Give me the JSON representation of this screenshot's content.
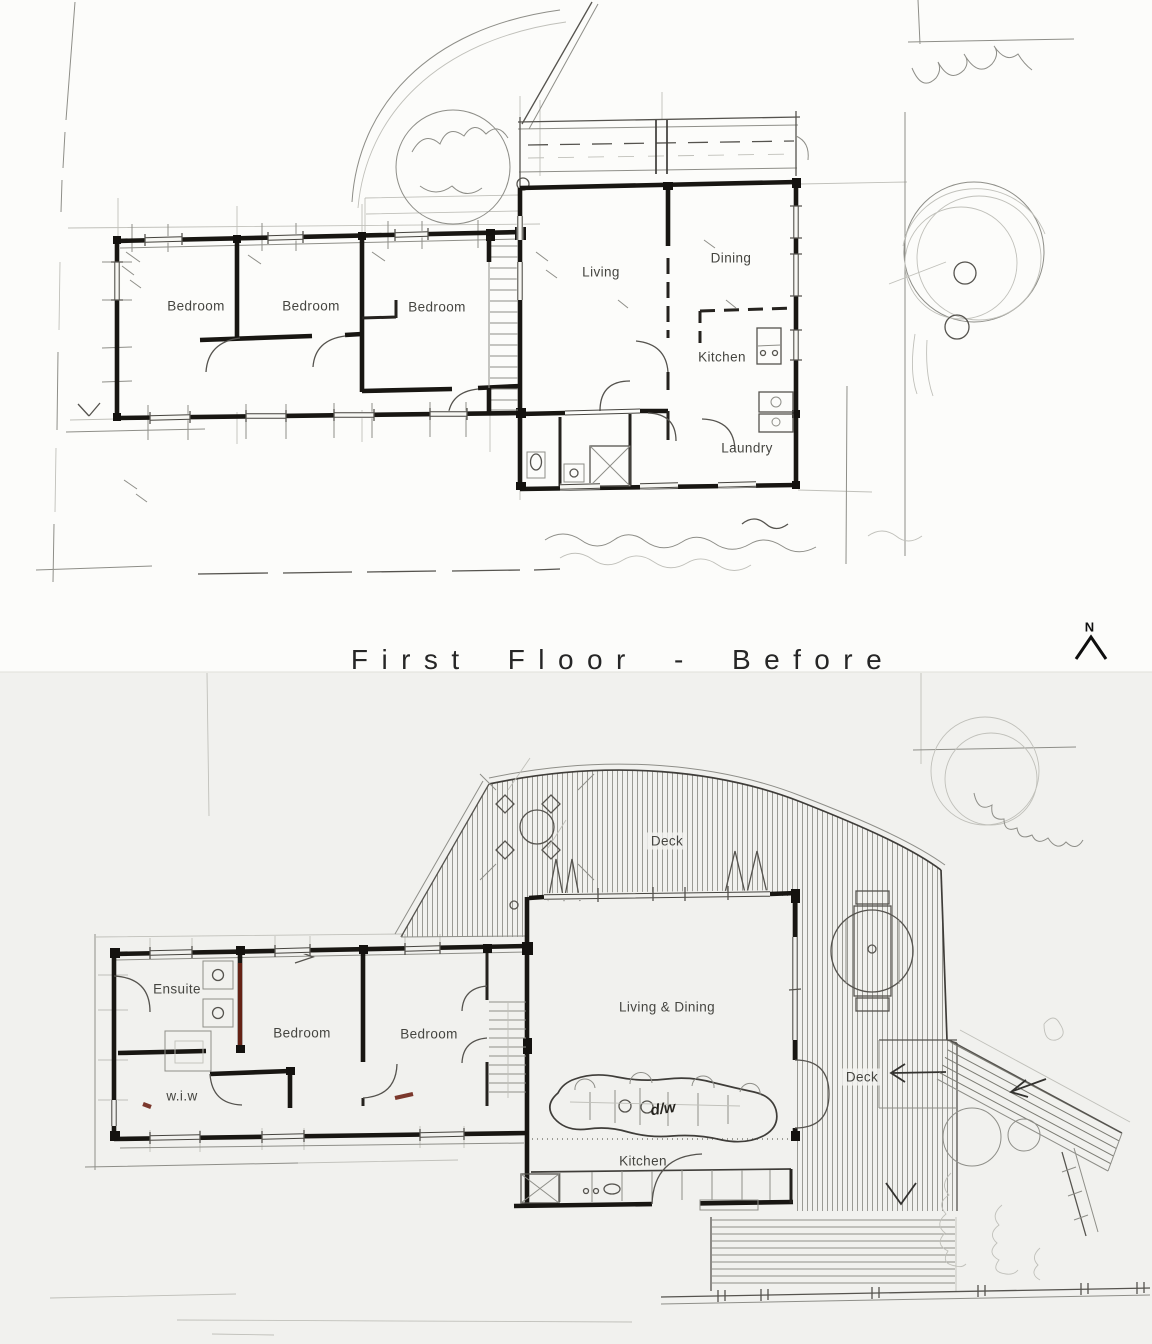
{
  "divider": {
    "title": "First Floor - Before"
  },
  "north_arrow": {
    "label": "N"
  },
  "plan_before": {
    "rooms": {
      "bedroom_1": "Bedroom",
      "bedroom_2": "Bedroom",
      "bedroom_3": "Bedroom",
      "living": "Living",
      "dining": "Dining",
      "kitchen": "Kitchen",
      "laundry": "Laundry"
    }
  },
  "plan_after": {
    "rooms": {
      "ensuite": "Ensuite",
      "wiw": "w.i.w",
      "bedroom_1": "Bedroom",
      "bedroom_2": "Bedroom",
      "living_dining": "Living & Dining",
      "kitchen": "Kitchen",
      "deck_upper": "Deck",
      "deck_side": "Deck"
    },
    "annotations": {
      "dishwasher": "d/w"
    }
  },
  "colors": {
    "paper_top": "#fcfcfa",
    "paper_bottom": "#f1f1ee",
    "ink": "#181612",
    "pencil": "#8e8e88",
    "accent_red": "#6e2316"
  }
}
